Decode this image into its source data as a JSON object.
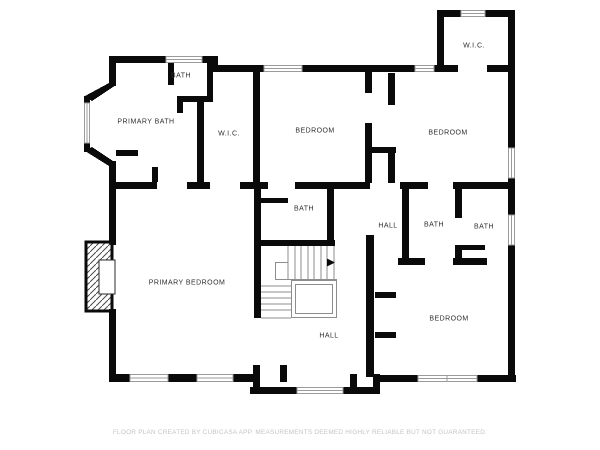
{
  "floorplan": {
    "rooms": [
      {
        "id": "bath-top-left",
        "label": "BATH"
      },
      {
        "id": "primary-bath",
        "label": "PRIMARY BATH"
      },
      {
        "id": "wic-left",
        "label": "W.I.C."
      },
      {
        "id": "bedroom-middle",
        "label": "BEDROOM"
      },
      {
        "id": "wic-top-right",
        "label": "W.I.C."
      },
      {
        "id": "bedroom-top-right",
        "label": "BEDROOM"
      },
      {
        "id": "bath-stairs",
        "label": "BATH"
      },
      {
        "id": "hall-middle",
        "label": "HALL"
      },
      {
        "id": "bath-middle",
        "label": "BATH"
      },
      {
        "id": "bath-right",
        "label": "BATH"
      },
      {
        "id": "primary-bedroom",
        "label": "PRIMARY BEDROOM"
      },
      {
        "id": "bedroom-bottom-right",
        "label": "BEDROOM"
      },
      {
        "id": "hall-bottom",
        "label": "HALL"
      }
    ],
    "disclaimer": "FLOOR PLAN CREATED BY CUBICASA APP. MEASUREMENTS DEEMED HIGHLY RELIABLE BUT NOT GUARANTEED.",
    "colors": {
      "wall": "#0a0a0a",
      "background": "#ffffff",
      "stair_lines": "#8d8d8d",
      "window_trim": "#9b9b9b",
      "room_label": "#2e2e2e",
      "disclaimer_text": "#c4c4c4"
    }
  }
}
